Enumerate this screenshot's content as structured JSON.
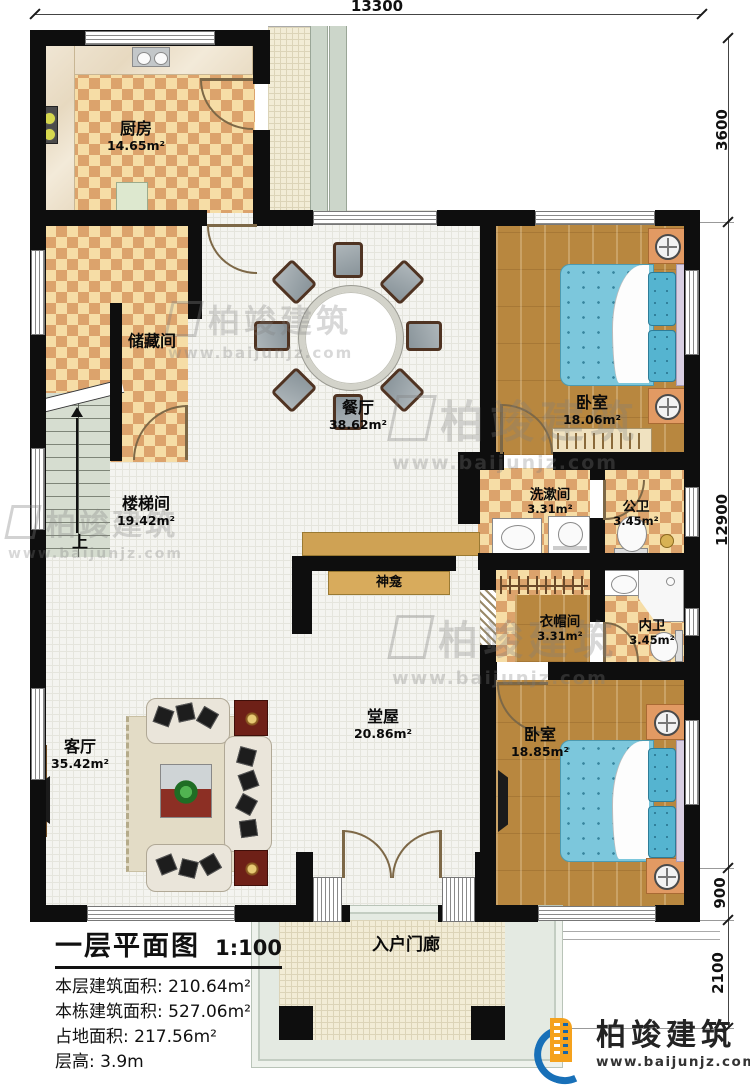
{
  "plan_title": "一层平面图",
  "dims": {
    "top": "13300",
    "right": [
      "3600",
      "12900",
      "900",
      "2100"
    ]
  },
  "rooms": {
    "kitchen": {
      "name": "厨房",
      "area": "14.65m²"
    },
    "storage": {
      "name": "储藏间"
    },
    "dining": {
      "name": "餐厅",
      "area": "38.62m²"
    },
    "bedroom1": {
      "name": "卧室",
      "area": "18.06m²"
    },
    "washroom": {
      "name": "洗漱间",
      "area": "3.31m²"
    },
    "publicbath": {
      "name": "公卫",
      "area": "3.45m²"
    },
    "stairwell": {
      "name": "楼梯间",
      "area": "19.42m²"
    },
    "shrine": {
      "name": "神龛"
    },
    "cloakroom": {
      "name": "衣帽间",
      "area": "3.31m²"
    },
    "privatebath": {
      "name": "内卫",
      "area": "3.45m²"
    },
    "hall": {
      "name": "堂屋",
      "area": "20.86m²"
    },
    "bedroom2": {
      "name": "卧室",
      "area": "18.85m²"
    },
    "living": {
      "name": "客厅",
      "area": "35.42m²"
    },
    "porch": {
      "name": "入户门廊"
    }
  },
  "stairs": {
    "up": "上"
  },
  "info": {
    "title": "一层平面图",
    "scale": "1:100",
    "lines": [
      {
        "label": "本层建筑面积:",
        "value": "210.64m²"
      },
      {
        "label": "本栋建筑面积:",
        "value": "527.06m²"
      },
      {
        "label": "占地面积:",
        "value": "217.56m²"
      },
      {
        "label": "层高:",
        "value": "3.9m"
      }
    ]
  },
  "branding": {
    "company": "柏竣建筑",
    "website": "www.baijunjz.com"
  },
  "colors": {
    "wall": "#0e0e0e",
    "checker_light": "#f6dda6",
    "checker_dark": "#dca36c",
    "wood": "#b8873f",
    "bed_blue": "#7cc7dc",
    "logo_blue": "#1870b8",
    "logo_orange": "#f5a21d"
  }
}
